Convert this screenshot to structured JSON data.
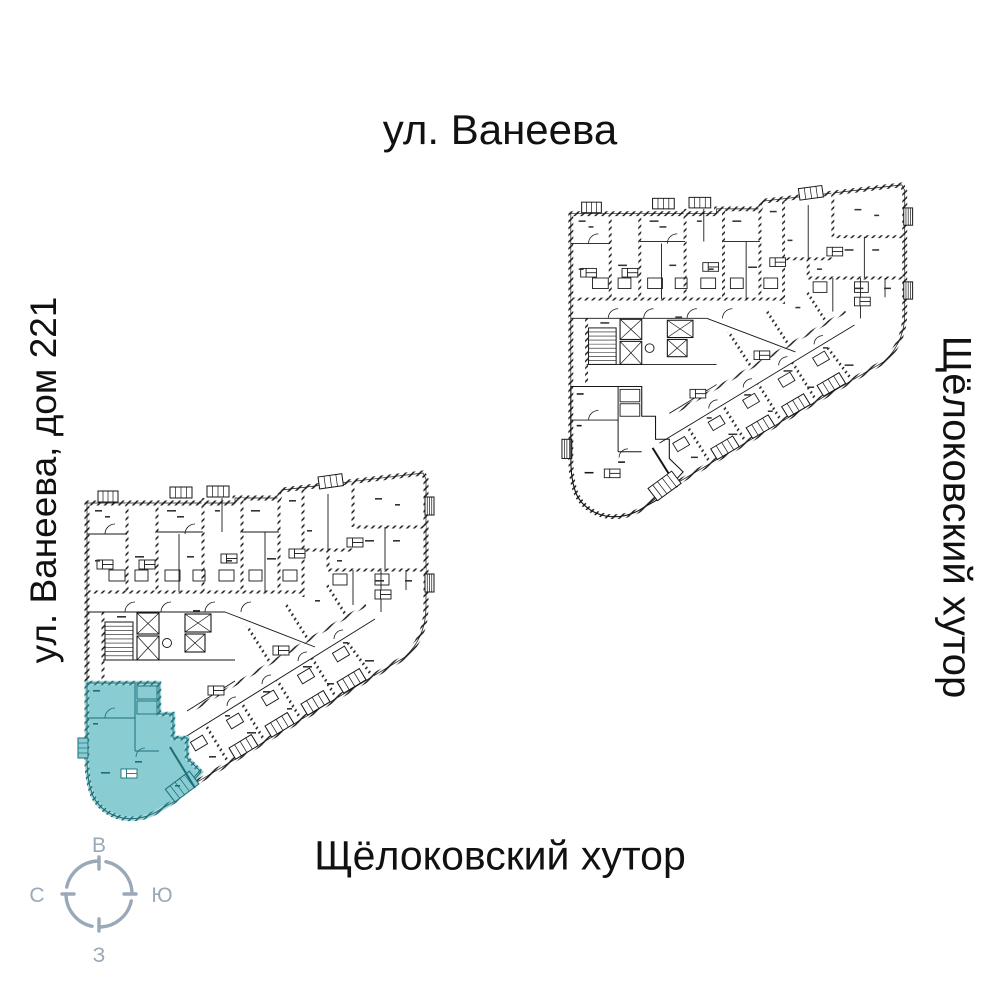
{
  "labels": {
    "street_top": "ул. Ванеева",
    "building_left": "ул. Ванеева, дом 221",
    "district_right": "Щёлоковский хутор",
    "district_bottom": "Щёлоковский хутор"
  },
  "compass": {
    "top": "В",
    "right": "Ю",
    "bottom": "З",
    "left": "С",
    "color": "#9aa9b8"
  },
  "plans": {
    "upper": {
      "highlighted_apartment": false
    },
    "lower": {
      "highlighted_apartment": true
    }
  },
  "colors": {
    "background": "#ffffff",
    "plan_ink": "#161616",
    "highlight_fill": "#89ccd2",
    "highlight_ink": "#1d6e79",
    "highlight_wall": "#2e93a0",
    "compass": "#9aa9b8"
  }
}
